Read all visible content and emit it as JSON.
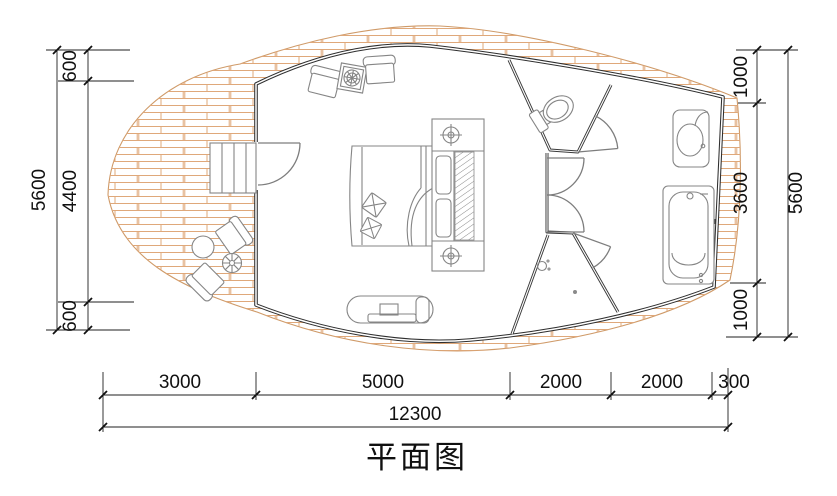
{
  "title": "平面图",
  "colors": {
    "brick_hatch": "#dfa87a",
    "deck_outline": "#cf9a68",
    "wall": "#2e2e2e",
    "furniture_line": "#858585",
    "dimension_line": "#1f1f1f",
    "text": "#111111",
    "background": "#ffffff"
  },
  "dimensions": {
    "left": {
      "total": "5600",
      "segments": [
        "600",
        "4400",
        "600"
      ]
    },
    "right": {
      "total": "5600",
      "segments": [
        "1000",
        "3600",
        "1000"
      ]
    },
    "bottom": {
      "total": "12300",
      "segments": [
        "3000",
        "5000",
        "2000",
        "2000",
        "300"
      ]
    }
  },
  "legend": {
    "fixtures": [
      "stairs",
      "entry-door",
      "armchair",
      "coffee-table",
      "double-bed",
      "wardrobe",
      "tv-cabinet",
      "toilet",
      "washbasin",
      "bathtub",
      "shower",
      "deck-table",
      "deck-chair",
      "planter"
    ]
  }
}
